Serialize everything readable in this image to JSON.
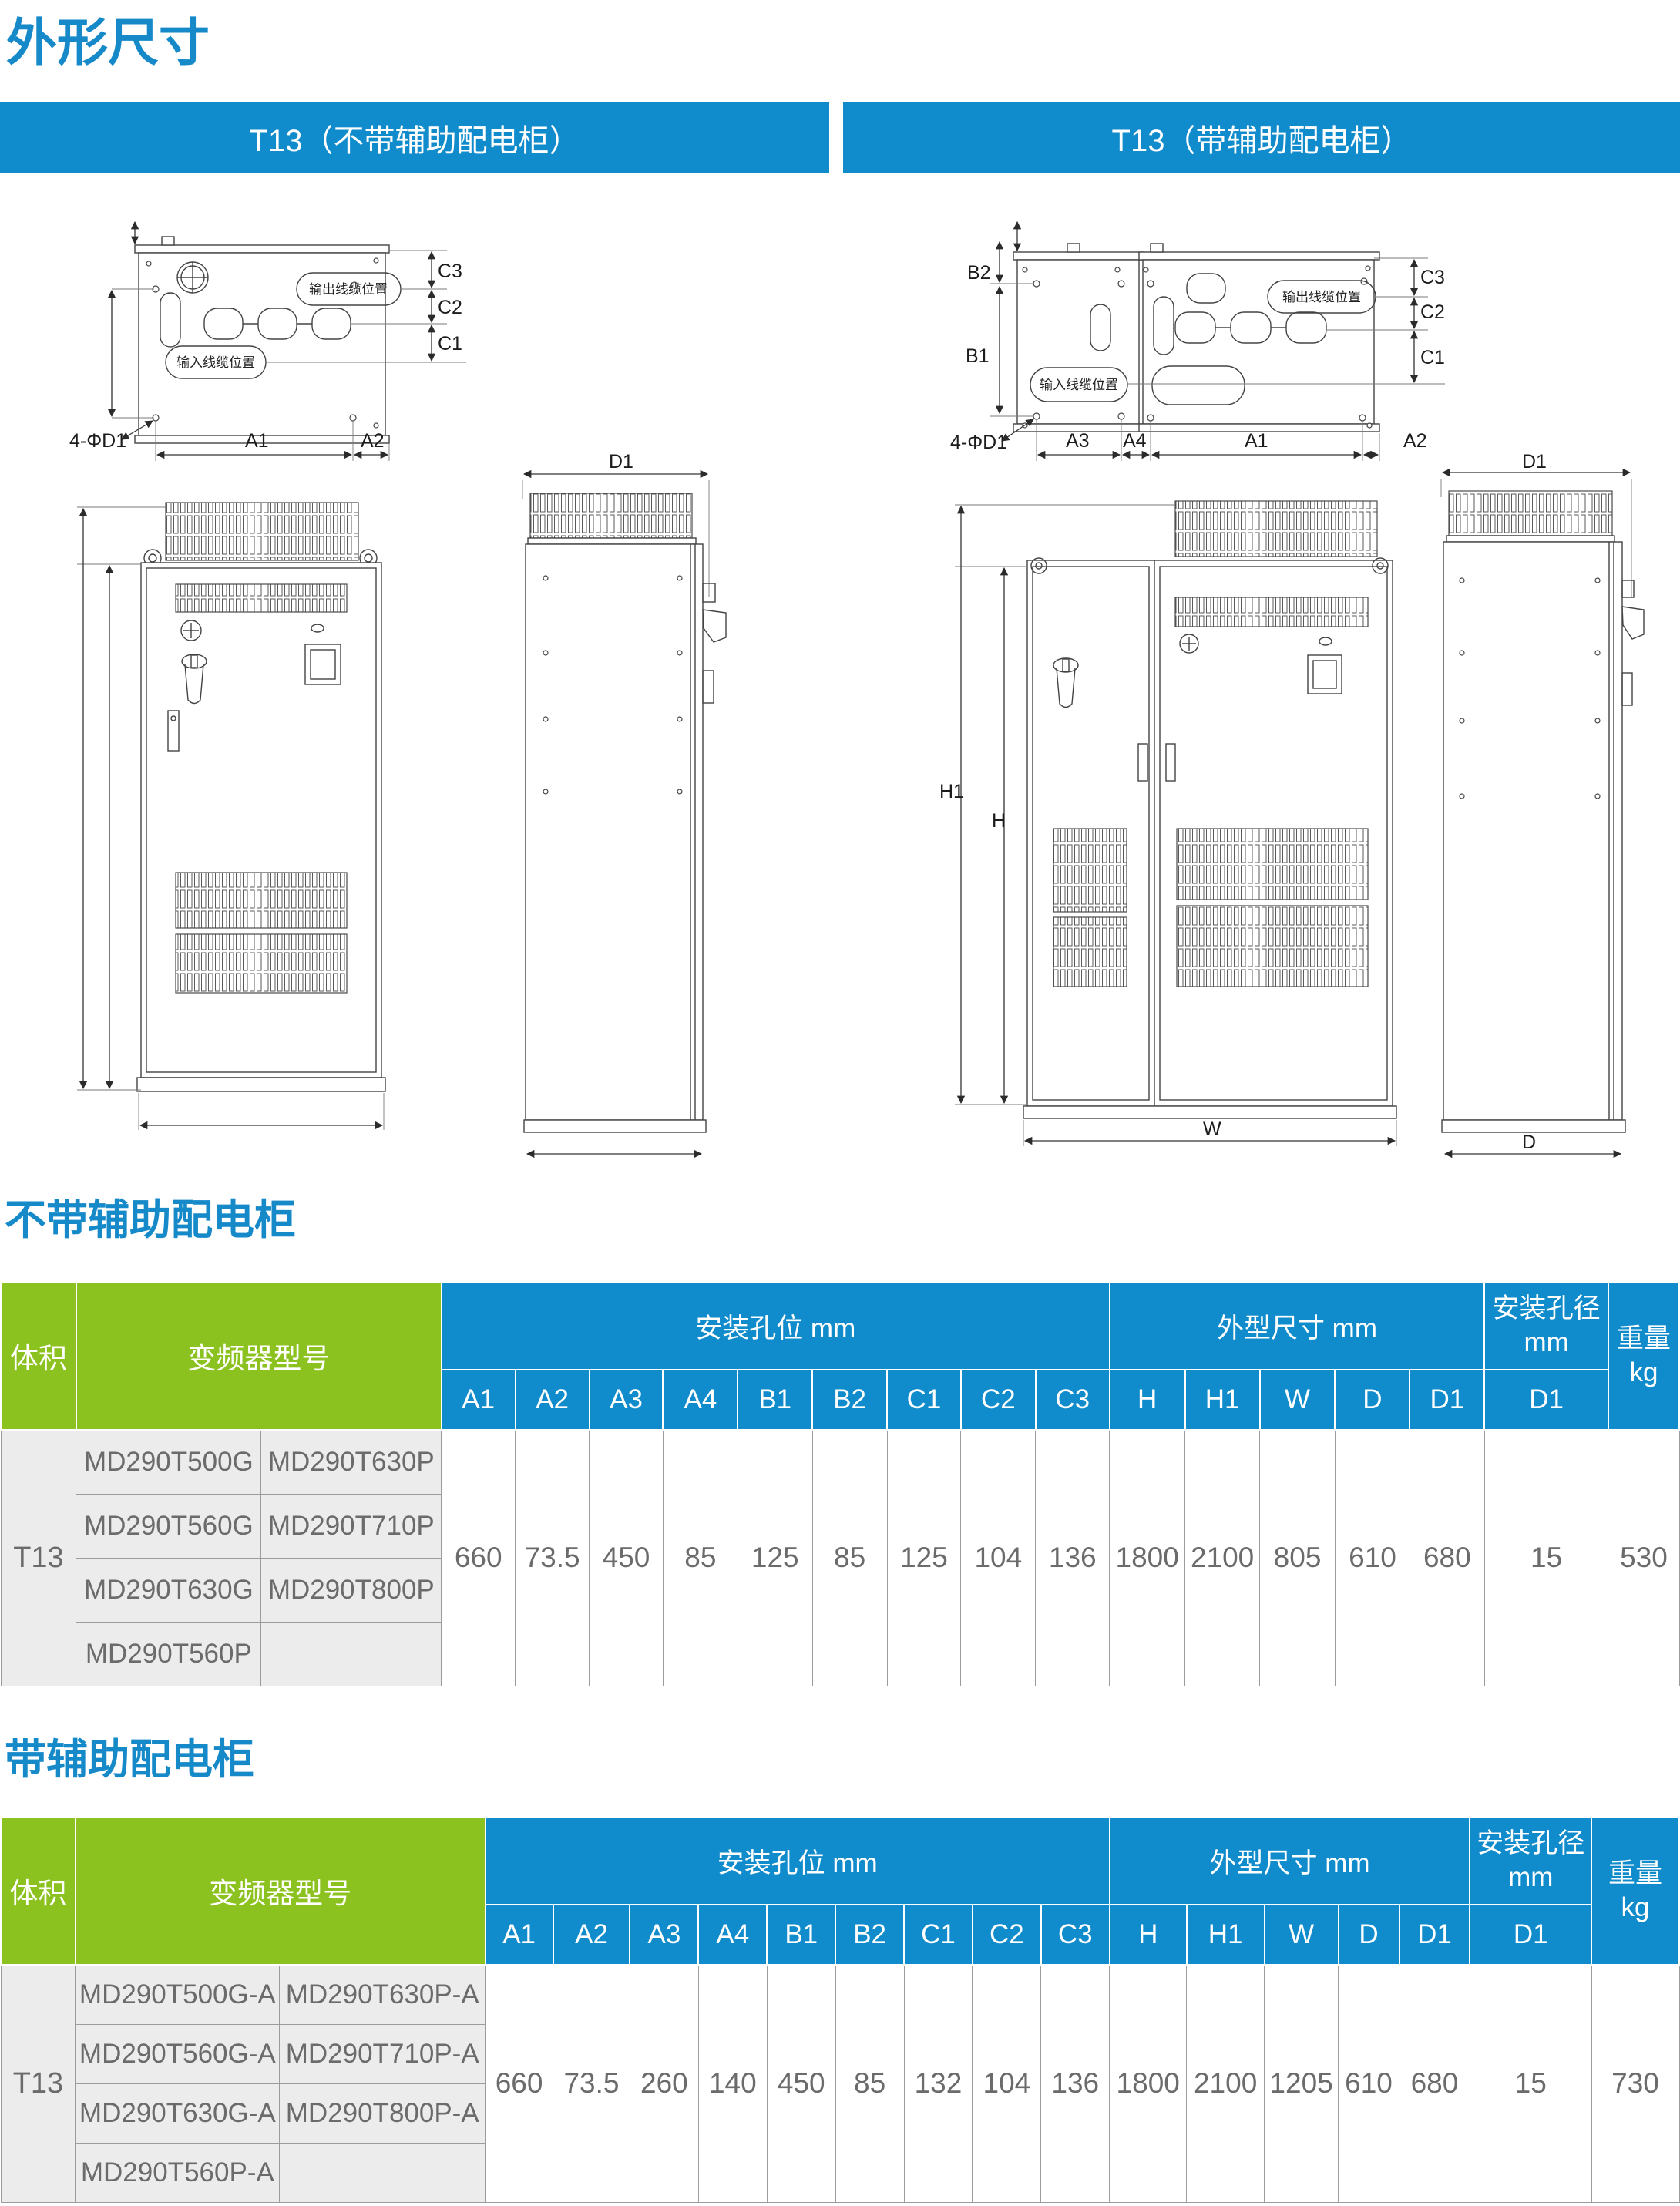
{
  "page": {
    "title": "外形尺寸"
  },
  "banners": [
    {
      "label": "T13（不带辅助配电柜）"
    },
    {
      "label": "T13（带辅助配电柜）"
    }
  ],
  "colors": {
    "accent_blue": "#108BCB",
    "accent_green": "#8CC21F"
  },
  "drawings": {
    "labels": {
      "a1": "A1",
      "a2": "A2",
      "a3": "A3",
      "a4": "A4",
      "b1": "B1",
      "b2": "B2",
      "c1": "C1",
      "c2": "C2",
      "c3": "C3",
      "h": "H",
      "h1": "H1",
      "w": "W",
      "d": "D",
      "d1": "D1",
      "holes": "4-ΦD1",
      "output_cable": "输出线缆位置",
      "input_cable": "输入线缆位置"
    }
  },
  "sections": [
    {
      "heading": "不带辅助配电柜",
      "table": {
        "volume_header": "体积",
        "model_header": "变频器型号",
        "mounting_header": "安装孔位 mm",
        "dim_header": "外型尺寸 mm",
        "hole_dia_header": "安装孔径",
        "hole_dia_unit": "mm",
        "weight_header": "重量",
        "weight_unit": "kg",
        "cols": [
          "A1",
          "A2",
          "A3",
          "A4",
          "B1",
          "B2",
          "C1",
          "C2",
          "C3",
          "H",
          "H1",
          "W",
          "D",
          "D1",
          "D1"
        ],
        "volume": "T13",
        "models": [
          [
            "MD290T500G",
            "MD290T630P"
          ],
          [
            "MD290T560G",
            "MD290T710P"
          ],
          [
            "MD290T630G",
            "MD290T800P"
          ],
          [
            "MD290T560P",
            ""
          ]
        ],
        "values": [
          "660",
          "73.5",
          "450",
          "85",
          "125",
          "85",
          "125",
          "104",
          "136",
          "1800",
          "2100",
          "805",
          "610",
          "680",
          "15",
          "530"
        ]
      }
    },
    {
      "heading": "带辅助配电柜",
      "table": {
        "volume_header": "体积",
        "model_header": "变频器型号",
        "mounting_header": "安装孔位 mm",
        "dim_header": "外型尺寸 mm",
        "hole_dia_header": "安装孔径",
        "hole_dia_unit": "mm",
        "weight_header": "重量",
        "weight_unit": "kg",
        "cols": [
          "A1",
          "A2",
          "A3",
          "A4",
          "B1",
          "B2",
          "C1",
          "C2",
          "C3",
          "H",
          "H1",
          "W",
          "D",
          "D1",
          "D1"
        ],
        "volume": "T13",
        "models": [
          [
            "MD290T500G-A",
            "MD290T630P-A"
          ],
          [
            "MD290T560G-A",
            "MD290T710P-A"
          ],
          [
            "MD290T630G-A",
            "MD290T800P-A"
          ],
          [
            "MD290T560P-A",
            ""
          ]
        ],
        "values": [
          "660",
          "73.5",
          "260",
          "140",
          "450",
          "85",
          "132",
          "104",
          "136",
          "1800",
          "2100",
          "1205",
          "610",
          "680",
          "15",
          "730"
        ]
      }
    }
  ]
}
